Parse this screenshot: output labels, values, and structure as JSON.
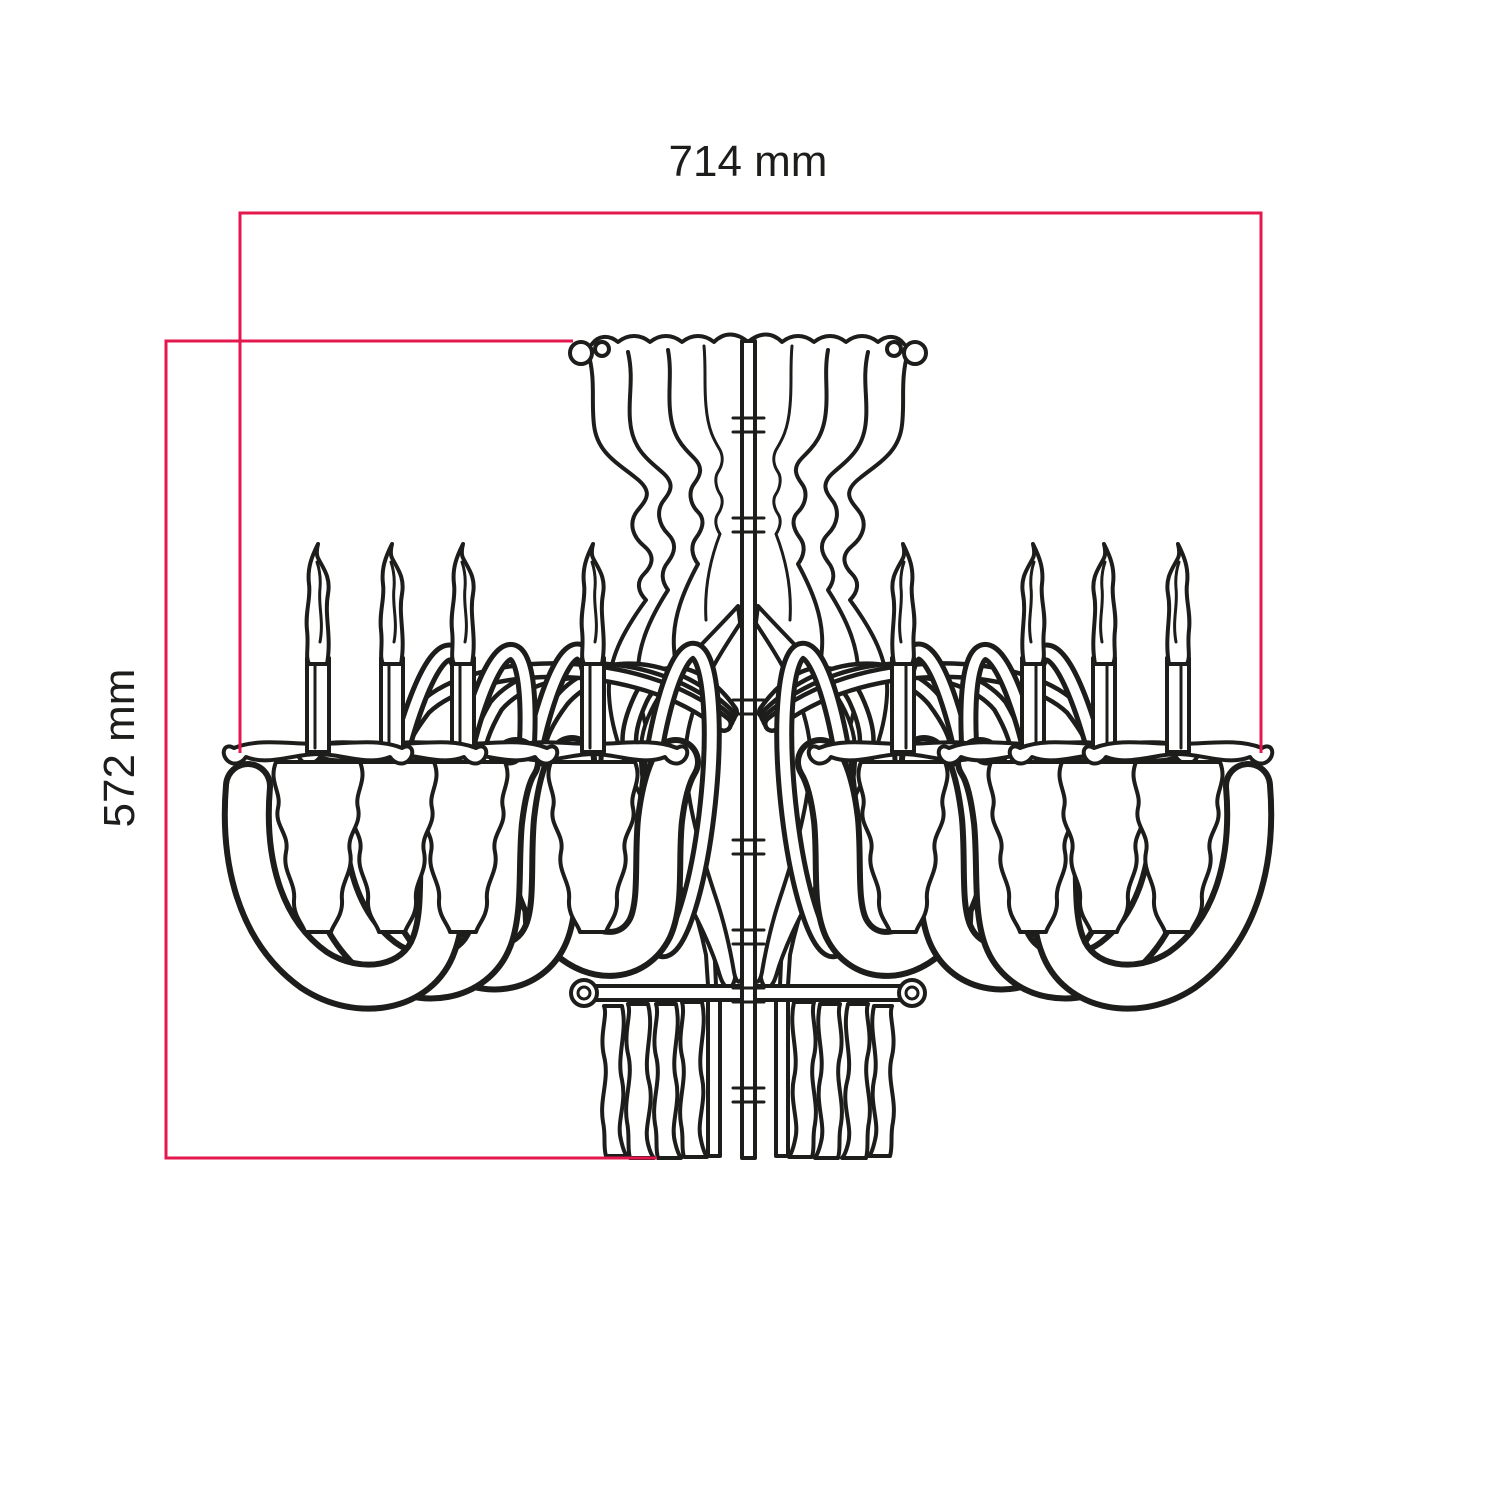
{
  "drawing": {
    "subject": "eight-arm flat-pack chandelier, front elevation line drawing"
  },
  "dimensions": {
    "width": {
      "label": "714 mm",
      "value_mm": 714,
      "unit": "mm"
    },
    "height": {
      "label": "572 mm",
      "value_mm": 572,
      "unit": "mm"
    }
  },
  "colors": {
    "dimension-line": "#e4174e",
    "ink": "#1d1d1b",
    "background": "#ffffff"
  }
}
